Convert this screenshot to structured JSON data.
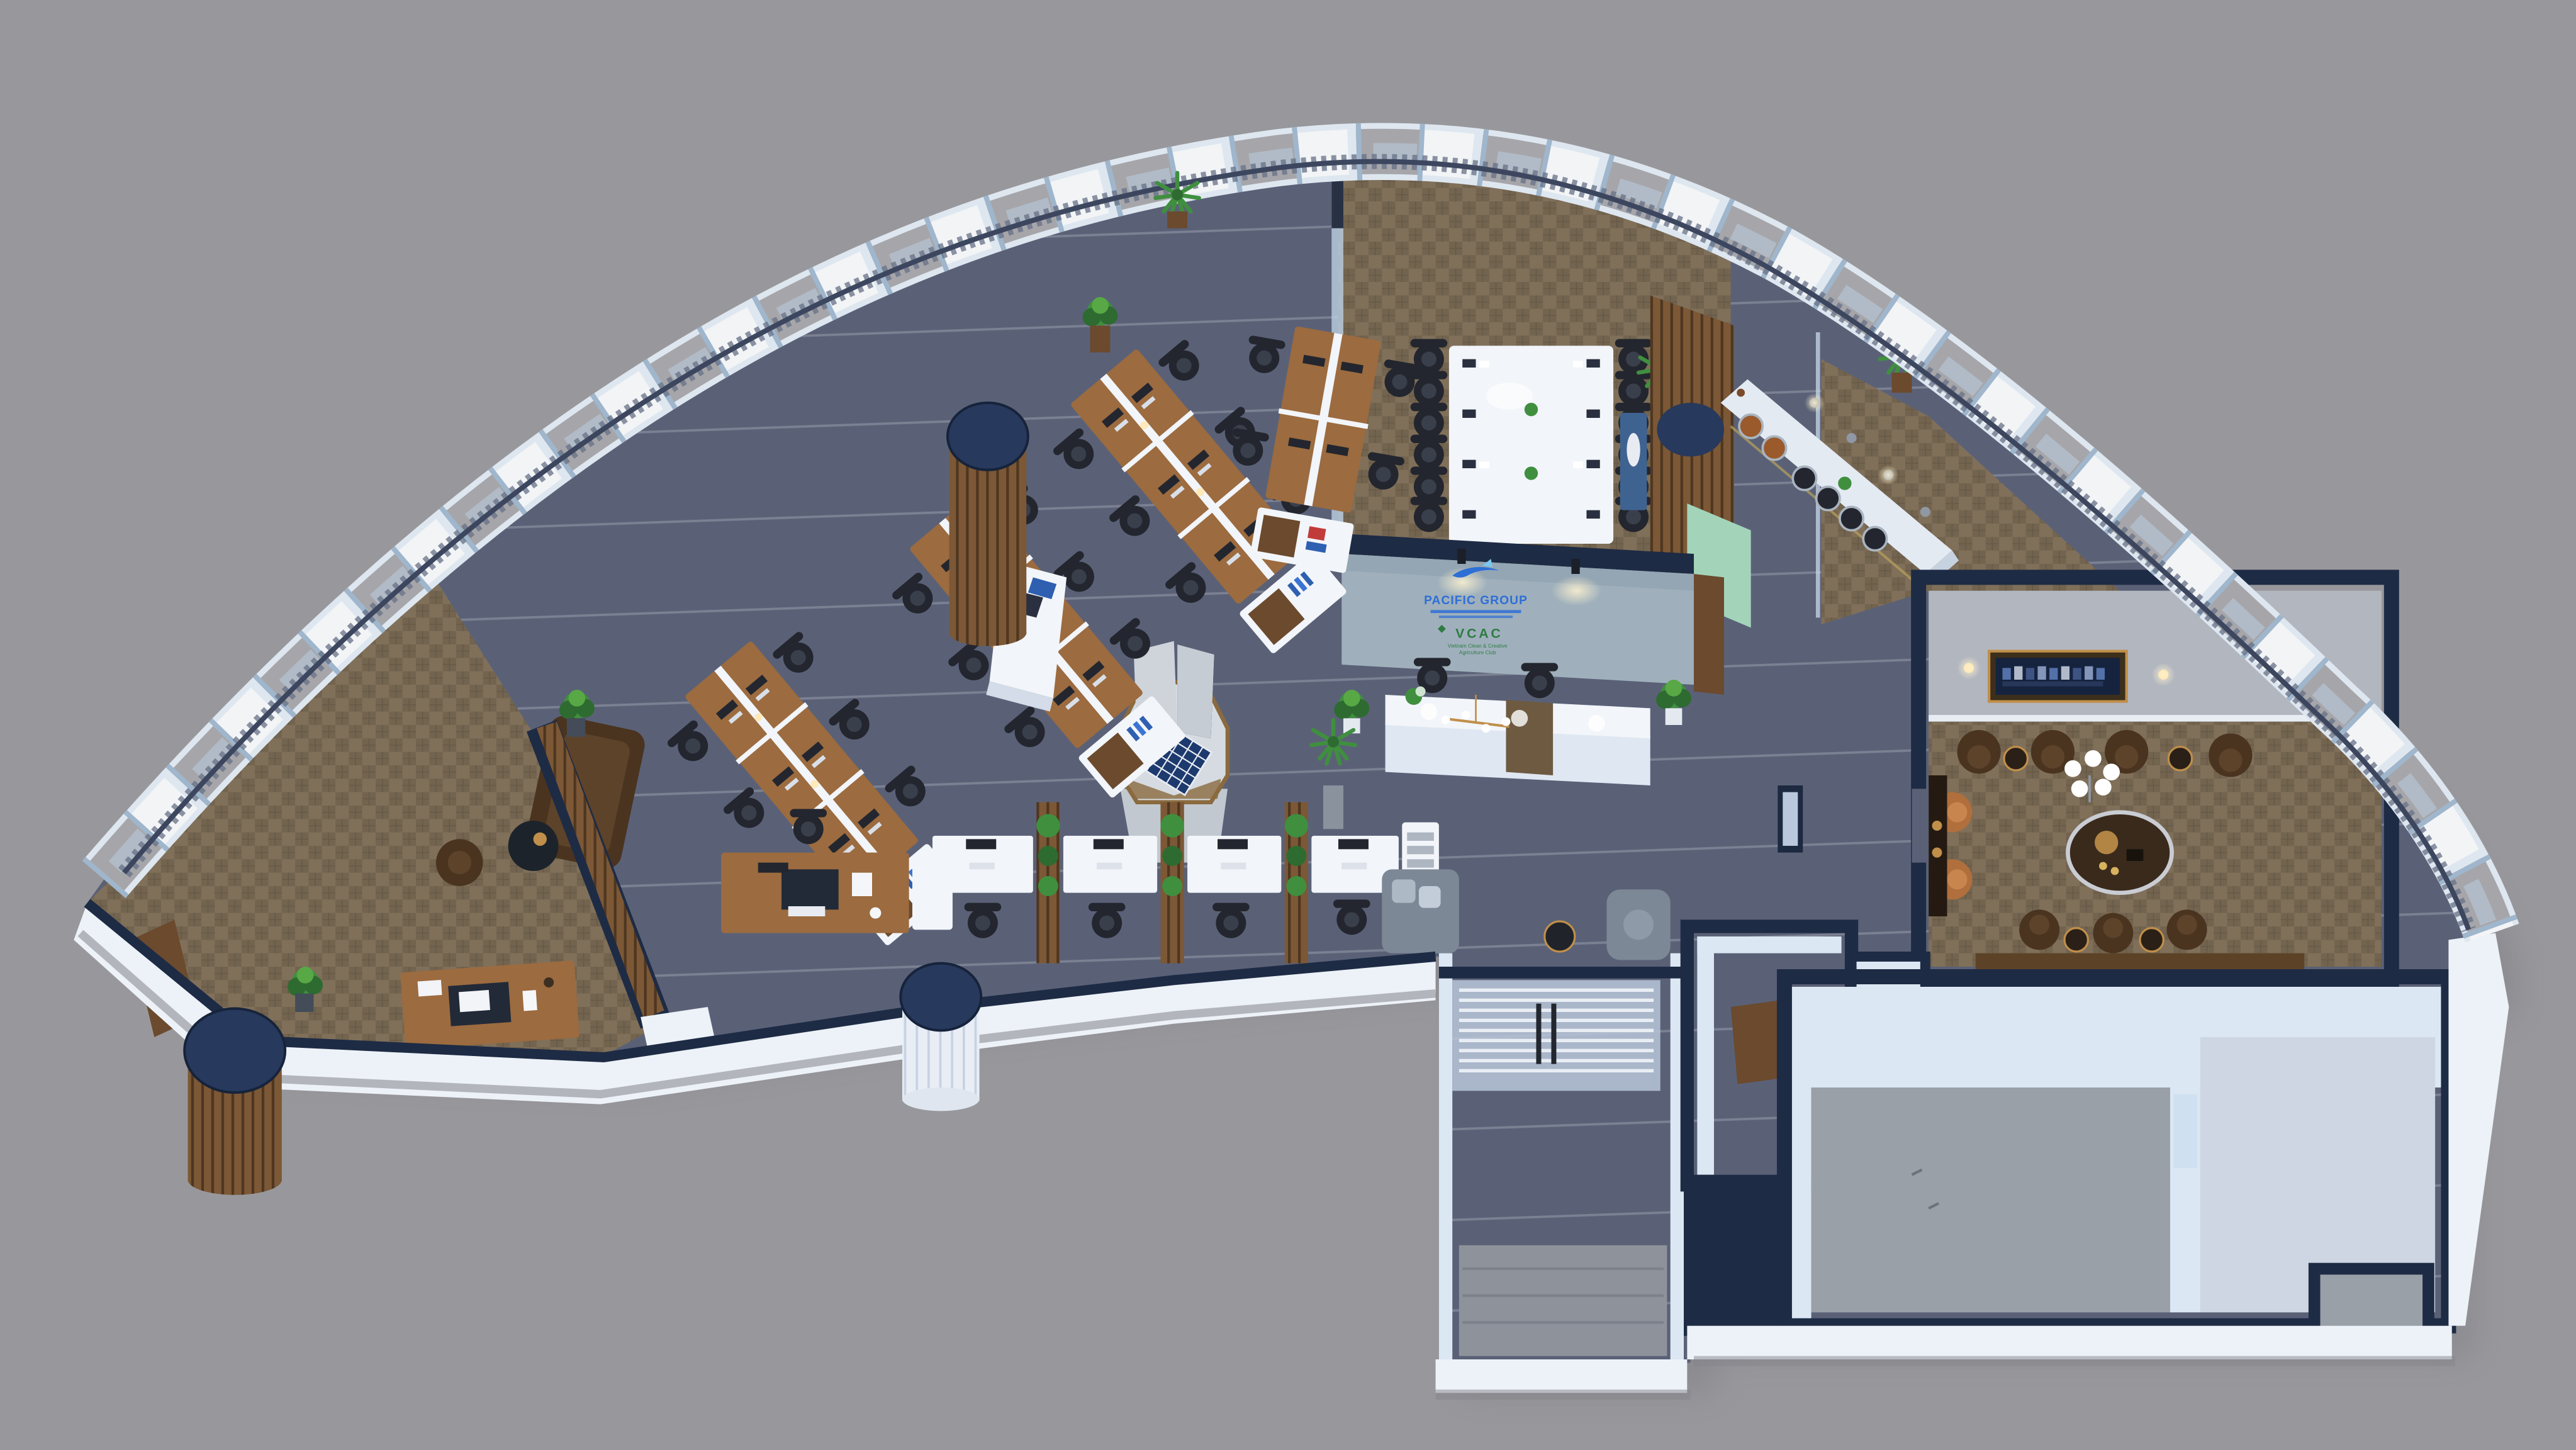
{
  "branding": {
    "company": "PACIFIC GROUP",
    "club_abbr": "VCAC",
    "club_line1": "Vietnam Clean & Creative",
    "club_line2": "Agriculture Club"
  },
  "icons": {
    "shark-logo-icon": "stylized blue shark swoosh above company name",
    "clover-icon": "small green diamond beside VCAC",
    "solar-panel-icon": "blue photovoltaic panel on display pedestal"
  },
  "areas": [
    "open-plan-office",
    "conference-room",
    "reception",
    "executive-office",
    "vip-lounge",
    "bar-counter",
    "entrance-corridor",
    "storage-room",
    "unfurnished-room",
    "waiting-area",
    "product-display"
  ],
  "colors": {
    "background": "#98989c",
    "navy": "#1e2b44",
    "navyCap": "#27395c",
    "wallWhite": "#edf2f8",
    "wallFace": "#dce7f4",
    "carpetDark": "#5a6177",
    "carpetStripe": "#aab1c4",
    "carpetBrown": "#80705a",
    "carpetBrownAlt": "#6e5f4a",
    "floorGray": "#9aa0a8",
    "floorLight": "#cdd6e2",
    "landingGray": "#8e939b",
    "woodDesk": "#9c6b3f",
    "woodDark": "#6b4a2e",
    "woodSlat": "#7c5836",
    "furnitureWhite": "#f2f5f9",
    "chairDark": "#23262e",
    "leatherDark": "#4a3420",
    "leatherTan": "#b06f3c",
    "sofaGray": "#7d8896",
    "plantGreen": "#3f8f3f",
    "plantDark": "#2e6b30",
    "brass": "#c08f4a",
    "logoBlue": "#2e6fd6",
    "logoGreen": "#2f7b43",
    "concrete": "#9fb0bc",
    "mint": "#a3d4ba",
    "consoleBlue": "#3f6391",
    "mullion": "#9fb6cc",
    "facadeWhite": "#f2f4f6",
    "facadeGray": "#a6a6aa",
    "facadeFrame": "#dee7f0",
    "glassTint": "#bcd0e4",
    "lampWarm": "#ffdf9e",
    "tvScreen": "#15233f",
    "counterBronze": "#6d5a41"
  }
}
